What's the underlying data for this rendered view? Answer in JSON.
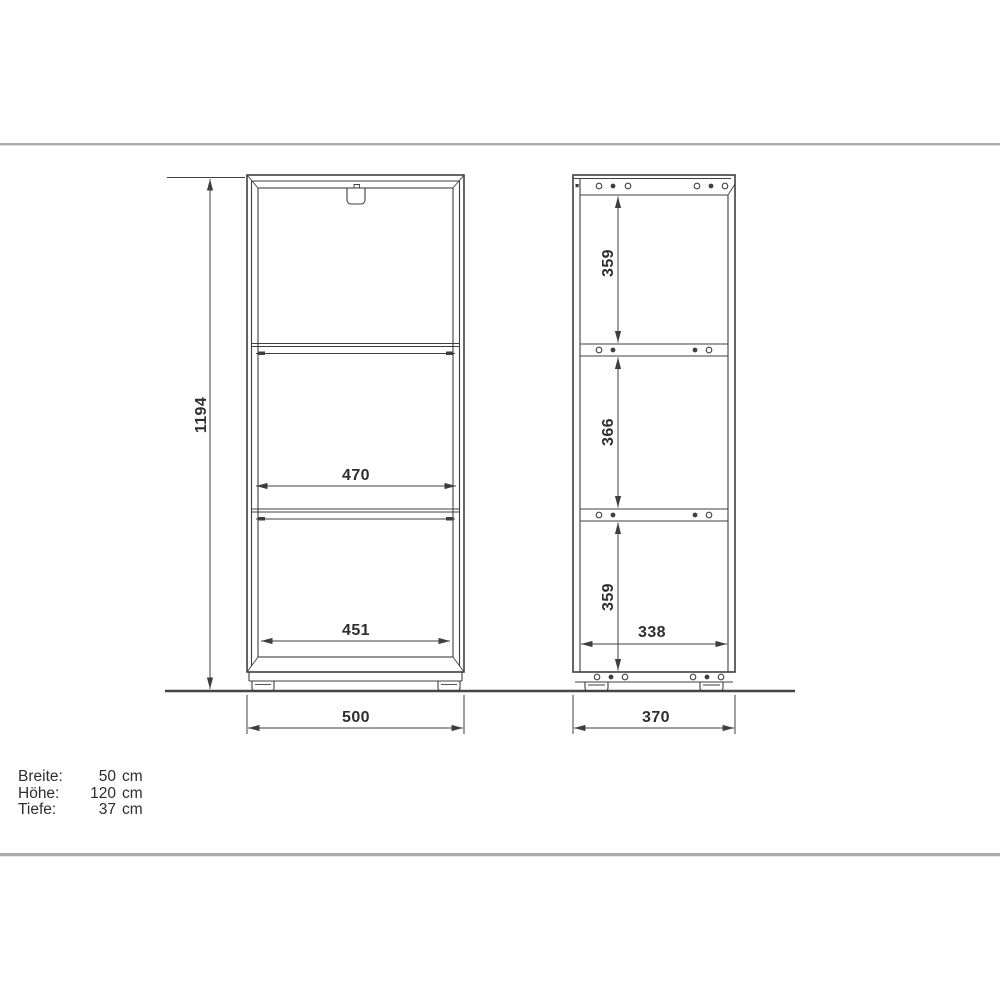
{
  "page": {
    "colors": {
      "background": "#ffffff",
      "line": "#3f3f3f",
      "separator": "#ababab",
      "text": "#2d2d2d"
    }
  },
  "front_view": {
    "dims": {
      "height": "1194",
      "upper_inner_width": "470",
      "lower_inner_width": "451",
      "outer_width": "500"
    }
  },
  "side_view": {
    "dims": {
      "top_section": "359",
      "middle_section": "366",
      "bottom_section": "359",
      "inner_depth": "338",
      "outer_depth": "370"
    }
  },
  "specs": {
    "rows": [
      {
        "label": "Breite:",
        "value": "50",
        "unit": "cm"
      },
      {
        "label": "Höhe:",
        "value": "120",
        "unit": "cm"
      },
      {
        "label": "Tiefe:",
        "value": "37",
        "unit": "cm"
      }
    ]
  }
}
